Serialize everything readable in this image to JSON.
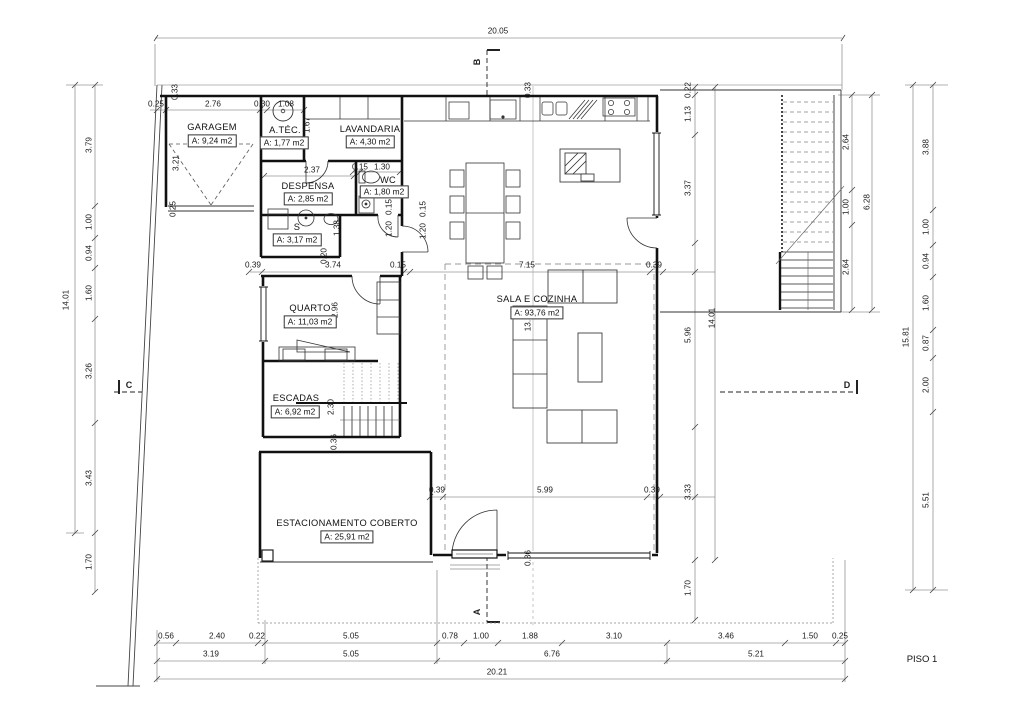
{
  "title": "PISO 1",
  "rooms": {
    "garagem": {
      "name": "GARAGEM",
      "area": "A: 9,24 m2"
    },
    "atec": {
      "name": "A.TÉC.",
      "area": "A: 1,77 m2"
    },
    "lavandaria": {
      "name": "LAVANDARIA",
      "area": "A: 4,30 m2"
    },
    "despensa": {
      "name": "DESPENSA",
      "area": "A: 2,85 m2"
    },
    "wc": {
      "name": "WC",
      "area": "A: 1,80 m2"
    },
    "s": {
      "name": "S",
      "area": "A: 3,17 m2"
    },
    "quarto": {
      "name": "QUARTO",
      "area": "A: 11,03 m2"
    },
    "escadas": {
      "name": "ESCADAS",
      "area": "A: 6,92 m2"
    },
    "sala": {
      "name": "SALA E COZINHA",
      "area": "A: 93,76 m2"
    },
    "estacionamento": {
      "name": "ESTACIONAMENTO COBERTO",
      "area": "A: 25,91 m2"
    }
  },
  "sections": {
    "a": "A",
    "b": "B",
    "c": "C",
    "d": "D"
  },
  "dims": {
    "top_total": "20.05",
    "bottom_row1": [
      "0.56",
      "2.40",
      "0.22",
      "5.05",
      "0.78",
      "1.00",
      "1.88",
      "3.10",
      "3.46",
      "1.50",
      "0.25"
    ],
    "bottom_row2": [
      "3.19",
      "5.05",
      "6.76",
      "5.21"
    ],
    "bottom_total": "20.21",
    "left": [
      "3.79",
      "1.00",
      "0.94",
      "1.60",
      "3.26",
      "3.43",
      "1.70"
    ],
    "left_total": "14.01",
    "inner_right": [
      "0.22",
      "1.13",
      "3.37",
      "5.96",
      "3.33",
      "1.70"
    ],
    "inner_right_total": "14.01",
    "stair": [
      "2.64",
      "1.00",
      "2.64"
    ],
    "stair_total": "6.28",
    "far_right": [
      "3.88",
      "1.00",
      "0.94",
      "1.60",
      "0.87",
      "2.00",
      "5.51"
    ],
    "far_right_total": "15.81",
    "garage_top": [
      "0.25",
      "2.76",
      "0.30",
      "1.08"
    ],
    "garage_left": [
      "0.33",
      "3.21",
      "0.25"
    ],
    "mid_row": [
      "0.39",
      "3.74",
      "0.15",
      "7.15",
      "0.39"
    ],
    "lower_row": [
      "0.39",
      "5.99",
      "0.39"
    ],
    "wc_top": [
      "0.15",
      "1.30"
    ],
    "wc_inner": [
      "0.15",
      "1.20"
    ],
    "hall_inner": [
      "0.15",
      "1.20"
    ],
    "despensa_width": "2.37",
    "lav_height": "1.67",
    "s_height": "1.38",
    "quarto_top": "0.20",
    "quarto_height": "2.96",
    "sala_height": "13.30",
    "stairs_run": "2.30",
    "stairs_gap": "0.36",
    "entry_gap": "0.36",
    "top_wall": "0.33"
  }
}
